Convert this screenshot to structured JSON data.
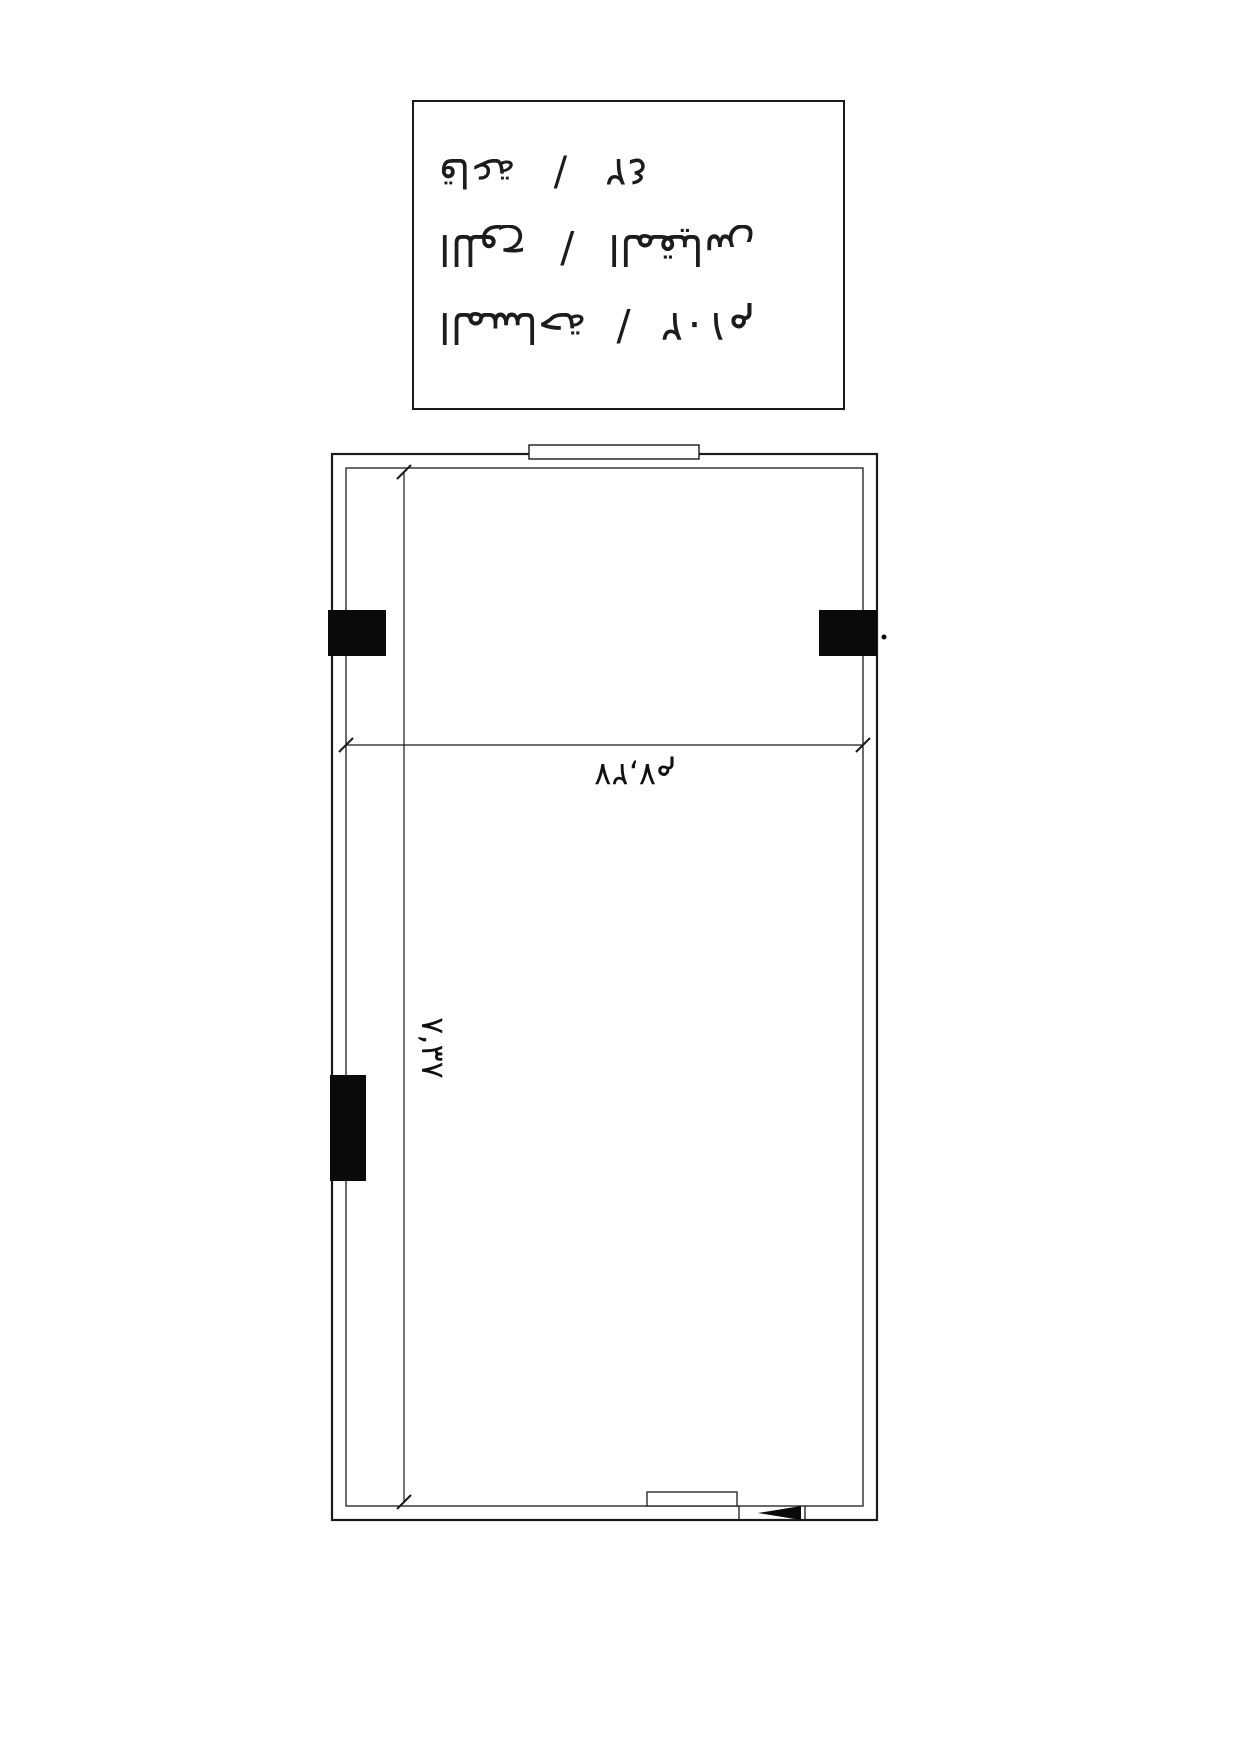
{
  "page": {
    "background": "#ffffff",
    "ink": "#1a1a1a",
    "orientation_note": "scanned upside-down"
  },
  "title_block": {
    "rows": [
      {
        "label": "قاعة",
        "separator": "/",
        "value": "٤٢"
      },
      {
        "label": "اللوح",
        "separator": "/",
        "value": "المقياس"
      },
      {
        "label": "المساحة",
        "separator": "/",
        "value": "١٠٢م"
      }
    ]
  },
  "floor_plan": {
    "horizontal_dimension": "٧,٢٧م",
    "vertical_dimension": "٧,٣٧"
  }
}
